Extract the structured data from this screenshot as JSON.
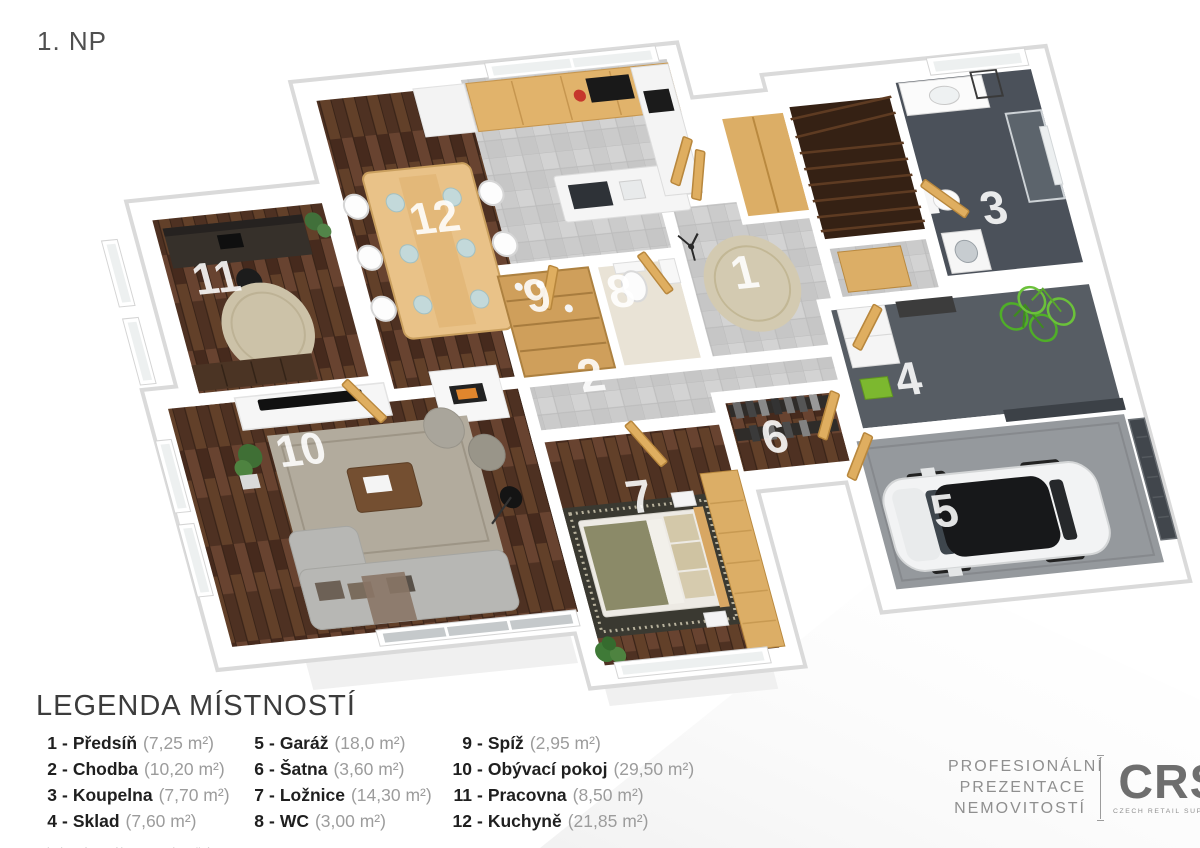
{
  "page": {
    "title": "1. NP"
  },
  "plan": {
    "rooms": [
      {
        "num": "1",
        "name": "Předsíň"
      },
      {
        "num": "2",
        "name": "Chodba"
      },
      {
        "num": "3",
        "name": "Koupelna"
      },
      {
        "num": "4",
        "name": "Sklad"
      },
      {
        "num": "5",
        "name": "Garáž"
      },
      {
        "num": "6",
        "name": "Šatna"
      },
      {
        "num": "7",
        "name": "Ložnice"
      },
      {
        "num": "8",
        "name": "WC"
      },
      {
        "num": "9",
        "name": "Spíž"
      },
      {
        "num": "10",
        "name": "Obývací pokoj"
      },
      {
        "num": "11",
        "name": "Pracovna"
      },
      {
        "num": "12",
        "name": "Kuchyně"
      }
    ]
  },
  "legend": {
    "title": "LEGENDA MÍSTNOSTÍ",
    "sep": "-",
    "items": [
      {
        "num": "1",
        "name": "Předsíň",
        "area": "(7,25 m²)"
      },
      {
        "num": "2",
        "name": "Chodba",
        "area": "(10,20 m²)"
      },
      {
        "num": "3",
        "name": "Koupelna",
        "area": "(7,70 m²)"
      },
      {
        "num": "4",
        "name": "Sklad",
        "area": "(7,60 m²)"
      },
      {
        "num": "5",
        "name": "Garáž",
        "area": "(18,0 m²)"
      },
      {
        "num": "6",
        "name": "Šatna",
        "area": "(3,60 m²)"
      },
      {
        "num": "7",
        "name": "Ložnice",
        "area": "(14,30 m²)"
      },
      {
        "num": "8",
        "name": "WC",
        "area": "(3,00 m²)"
      },
      {
        "num": "9",
        "name": "Spíž",
        "area": "(2,95 m²)"
      },
      {
        "num": "10",
        "name": "Obývací pokoj",
        "area": "(29,50 m²)"
      },
      {
        "num": "11",
        "name": "Pracovna",
        "area": "(8,50 m²)"
      },
      {
        "num": "12",
        "name": "Kuchyně",
        "area": "(21,85 m²)"
      }
    ],
    "footnote": "*Plocha místností je pouze orientační"
  },
  "brand": {
    "lines": [
      "PROFESIONÁLNÍ",
      "PREZENTACE",
      "NEMOVITOSTÍ"
    ],
    "mark": "CRS",
    "sub": "CZECH RETAIL SUPPORT"
  },
  "colors": {
    "floor_wood": "#5a3a29",
    "floor_tile": "#cbcbcb",
    "floor_bath": "#4b515a",
    "floor_storage": "#575d64",
    "floor_garage": "#95999d",
    "oak": "#dfae60",
    "wall": "#ffffff",
    "accent_green": "#7cb82f",
    "label_white": "#ffffff",
    "legend_text": "#1f1f1f",
    "muted_text": "#9c9c9c"
  }
}
